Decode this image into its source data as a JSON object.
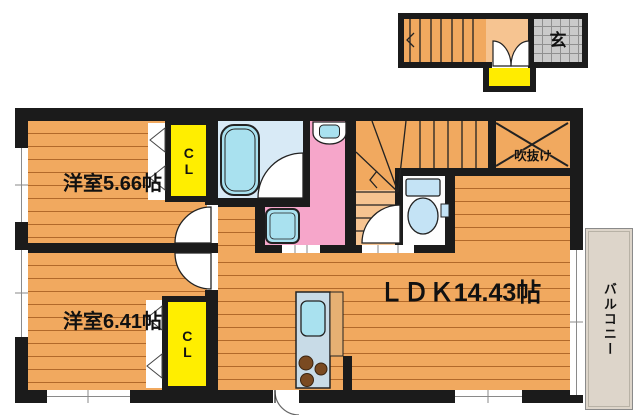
{
  "rooms": {
    "bedroom1": {
      "label": "洋室5.66帖"
    },
    "bedroom2": {
      "label": "洋室6.41帖"
    },
    "ldk": {
      "label": "ＬＤＫ14.43帖"
    },
    "closet1": {
      "label": "CL"
    },
    "closet2": {
      "label": "CL"
    },
    "entrance": {
      "label": "玄"
    },
    "void": {
      "label": "吹抜け"
    },
    "balcony": {
      "label": "バルコニー"
    }
  },
  "colors": {
    "wall": "#1b1b1b",
    "wood": "#f1a95f",
    "wood_line": "#b2692a",
    "landing": "#f6c491",
    "closet": "#ffee00",
    "porch": "#ffec00",
    "washroom": "#f6a6ca",
    "bathroom": "#d8eaf6",
    "fixture": "#a9e1ef",
    "toilet_fixture": "#c4e3f5",
    "tile": "#cacaca",
    "tile_line": "#8f8f8f",
    "balcony_floor": "#ddd5ca",
    "kitchen_unit": "#c8dbe7",
    "counter": "#e6b073"
  }
}
